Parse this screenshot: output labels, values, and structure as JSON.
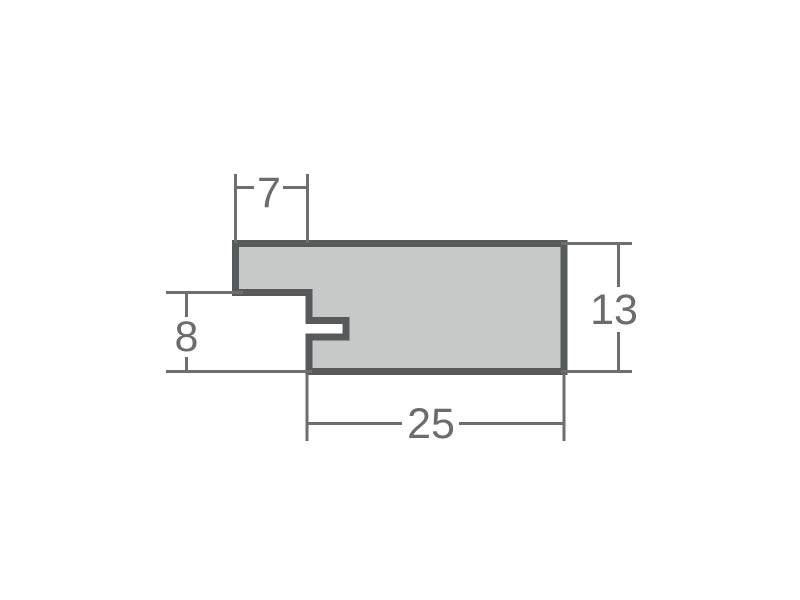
{
  "diagram": {
    "name": "frame-profile-cross-section",
    "dimensions": {
      "top_width": {
        "label": "7"
      },
      "left_height": {
        "label": "8"
      },
      "right_height": {
        "label": "13"
      },
      "bottom_width": {
        "label": "25"
      }
    }
  },
  "colors": {
    "background": "#ffffff",
    "profile_fill": "#c7c8c8",
    "profile_outline": "#58595a",
    "dimension_line": "#6d6e6e",
    "dimension_text": "#6c6c6c"
  }
}
